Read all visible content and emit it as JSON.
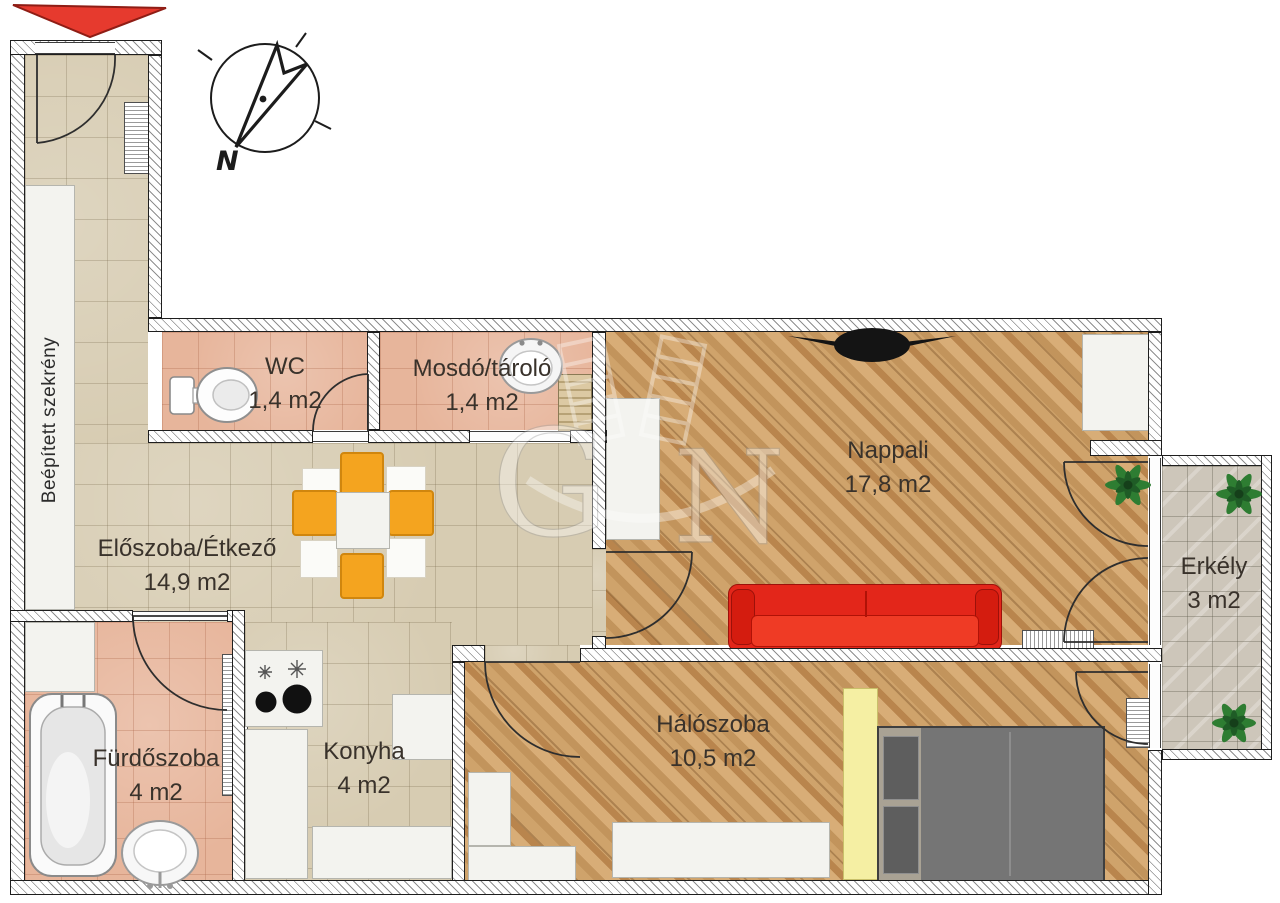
{
  "plan": {
    "rooms": [
      {
        "name": "WC",
        "area": "1,4 m2"
      },
      {
        "name": "Mosdó/tároló",
        "area": "1,4 m2"
      },
      {
        "name": "Nappali",
        "area": "17,8 m2"
      },
      {
        "name": "Előszoba/Étkező",
        "area": "14,9 m2"
      },
      {
        "name": "Erkély",
        "area": "3 m2"
      },
      {
        "name": "Fürdőszoba",
        "area": "4 m2"
      },
      {
        "name": "Konyha",
        "area": "4 m2"
      },
      {
        "name": "Hálószoba",
        "area": "10,5 m2"
      }
    ],
    "closet_label": "Beépített szekrény",
    "compass": {
      "north_label": "N"
    },
    "watermark": {
      "letter_left": "G",
      "letter_right": "N"
    },
    "colors": {
      "sofa": "#e3261a",
      "chairs": "#f4a41f",
      "bed": "#757575",
      "wardrobe_yellow": "#f5efa3",
      "entrance_arrow": "#e63a2e",
      "wood_floor": "#c99d66",
      "tile_beige": "#d7ccb2",
      "tile_salmon": "#e7b59b",
      "tile_balcony": "#cdc6ba"
    }
  }
}
